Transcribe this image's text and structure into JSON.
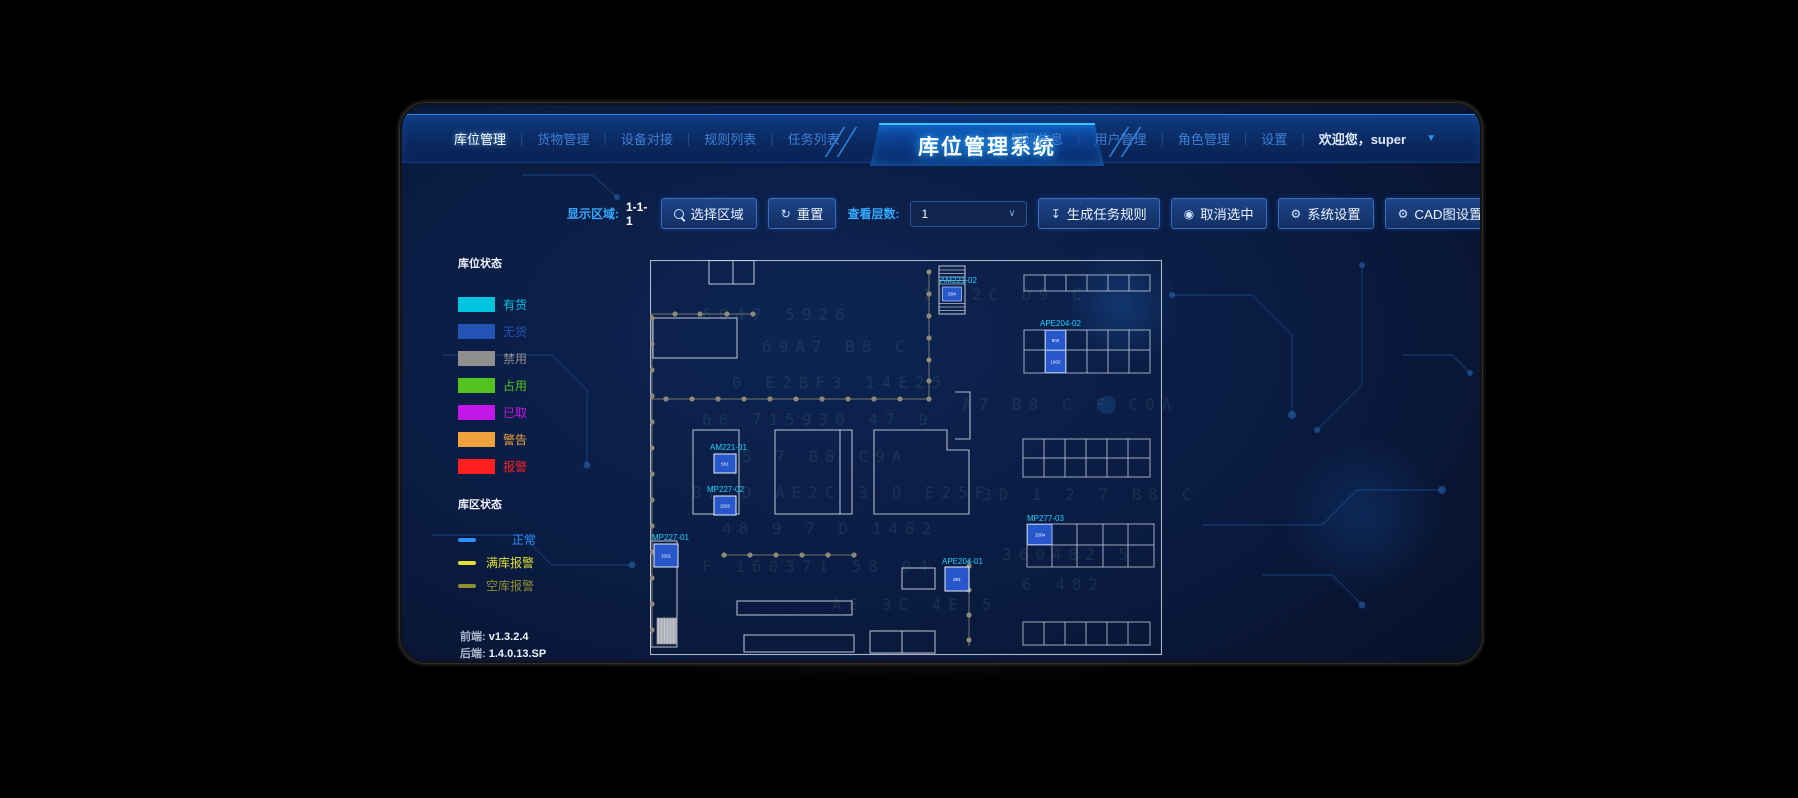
{
  "header": {
    "title": "库位管理系统",
    "sep": "|",
    "nav_left": [
      {
        "label": "库位管理",
        "active": true
      },
      {
        "label": "货物管理"
      },
      {
        "label": "设备对接"
      },
      {
        "label": "规则列表"
      },
      {
        "label": "任务列表"
      }
    ],
    "nav_right": [
      {
        "label": "扫码信息"
      },
      {
        "label": "用户管理"
      },
      {
        "label": "角色管理"
      },
      {
        "label": "设置"
      }
    ],
    "welcome": "欢迎您，super",
    "welcome_caret": "▼"
  },
  "toolbar": {
    "display_area_label": "显示区域:",
    "display_area_value": "1-1-1",
    "select_area_btn": "选择区域",
    "reset_btn": "重置",
    "reset_icon": "↻",
    "view_layer_label": "查看层数:",
    "layer_select_value": "1",
    "layer_select_chevron": "∨",
    "generate_task_btn": "生成任务规则",
    "generate_task_icon": "↧",
    "cancel_selected_btn": "取消选中",
    "cancel_selected_icon": "◉",
    "system_settings_btn": "系统设置",
    "system_settings_icon": "⚙",
    "cad_settings_btn": "CAD图设置",
    "cad_settings_icon": "⚙",
    "upload_file_btn": "上传文件",
    "upload_file_icon": "↥"
  },
  "legend": {
    "slot_status_title": "库位状态",
    "slot_items": [
      {
        "label": "有货",
        "color": "#00c4e0"
      },
      {
        "label": "无货",
        "color": "#2353b5"
      },
      {
        "label": "禁用",
        "color": "#8f8f8f"
      },
      {
        "label": "占用",
        "color": "#53c41f"
      },
      {
        "label": "已取",
        "color": "#c316e8"
      },
      {
        "label": "警告",
        "color": "#efa23c"
      },
      {
        "label": "报警",
        "color": "#ff1f1f"
      }
    ],
    "zone_status_title": "库区状态",
    "zone_items": [
      {
        "label": "正常",
        "color": "#2f8fff"
      },
      {
        "label": "满库报警",
        "color": "#e3df2e"
      },
      {
        "label": "空库报警",
        "color": "#8e8e2f"
      }
    ]
  },
  "plan": {
    "units": [
      {
        "label": "AM221-02",
        "cell": "504"
      },
      {
        "label": "APE204-02",
        "cell_top": "902",
        "cell_bottom": "1002"
      },
      {
        "label": "AM221-01",
        "cell": "501"
      },
      {
        "label": "MP227-02",
        "cell": "1502"
      },
      {
        "label": "MP227-01",
        "cell": "1501"
      },
      {
        "label": "APE204-01",
        "cell": "901"
      },
      {
        "label": "MP277-03",
        "cell": "1504"
      }
    ]
  },
  "footer": {
    "frontend_label": "前端:",
    "frontend_version": "v1.3.2.4",
    "backend_label": "后端:",
    "backend_version": "1.4.0.13.SP"
  },
  "backdrop": {
    "glyph_lines": [
      "6047 5926",
      "69A7 B8 C",
      "0 E2BF3 14E25",
      "60 715936 47 9",
      "5 7 B8 C9A",
      "BF D AE2C 3 0 E25F",
      "48 9 7 D 1482",
      "F 160371 58 04",
      "A7 B8 C F C0A",
      "3D 1 2 7 B8 C",
      "360482 5",
      "6 482",
      "AE 3C 4E 5",
      "1B 2C D9 C"
    ]
  }
}
